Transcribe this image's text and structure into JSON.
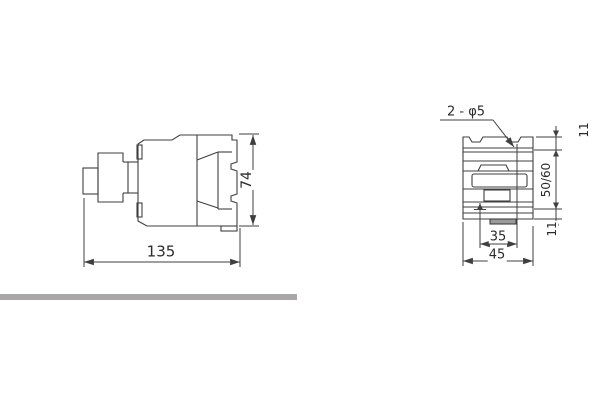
{
  "drawing": {
    "line_color": "#3f3f3f",
    "text_color": "#2b2b2b",
    "divider_color": "#a8a6a6",
    "background": "#ffffff"
  },
  "side_view": {
    "description": "contactor side profile outline drawing",
    "dimensions": {
      "overall_length": {
        "label": "135"
      },
      "overall_height": {
        "label": "74"
      }
    }
  },
  "front_view": {
    "description": "contactor front outline drawing with mounting holes",
    "hole_callout": {
      "label": "2 - φ5"
    },
    "dimensions": {
      "top_hole_offset": {
        "label": "11"
      },
      "vertical_hole_pitch": {
        "label": "50/60"
      },
      "bottom_hole_offset": {
        "label": "11"
      },
      "horizontal_hole_pitch": {
        "label": "35"
      },
      "overall_width": {
        "label": "45"
      }
    }
  }
}
